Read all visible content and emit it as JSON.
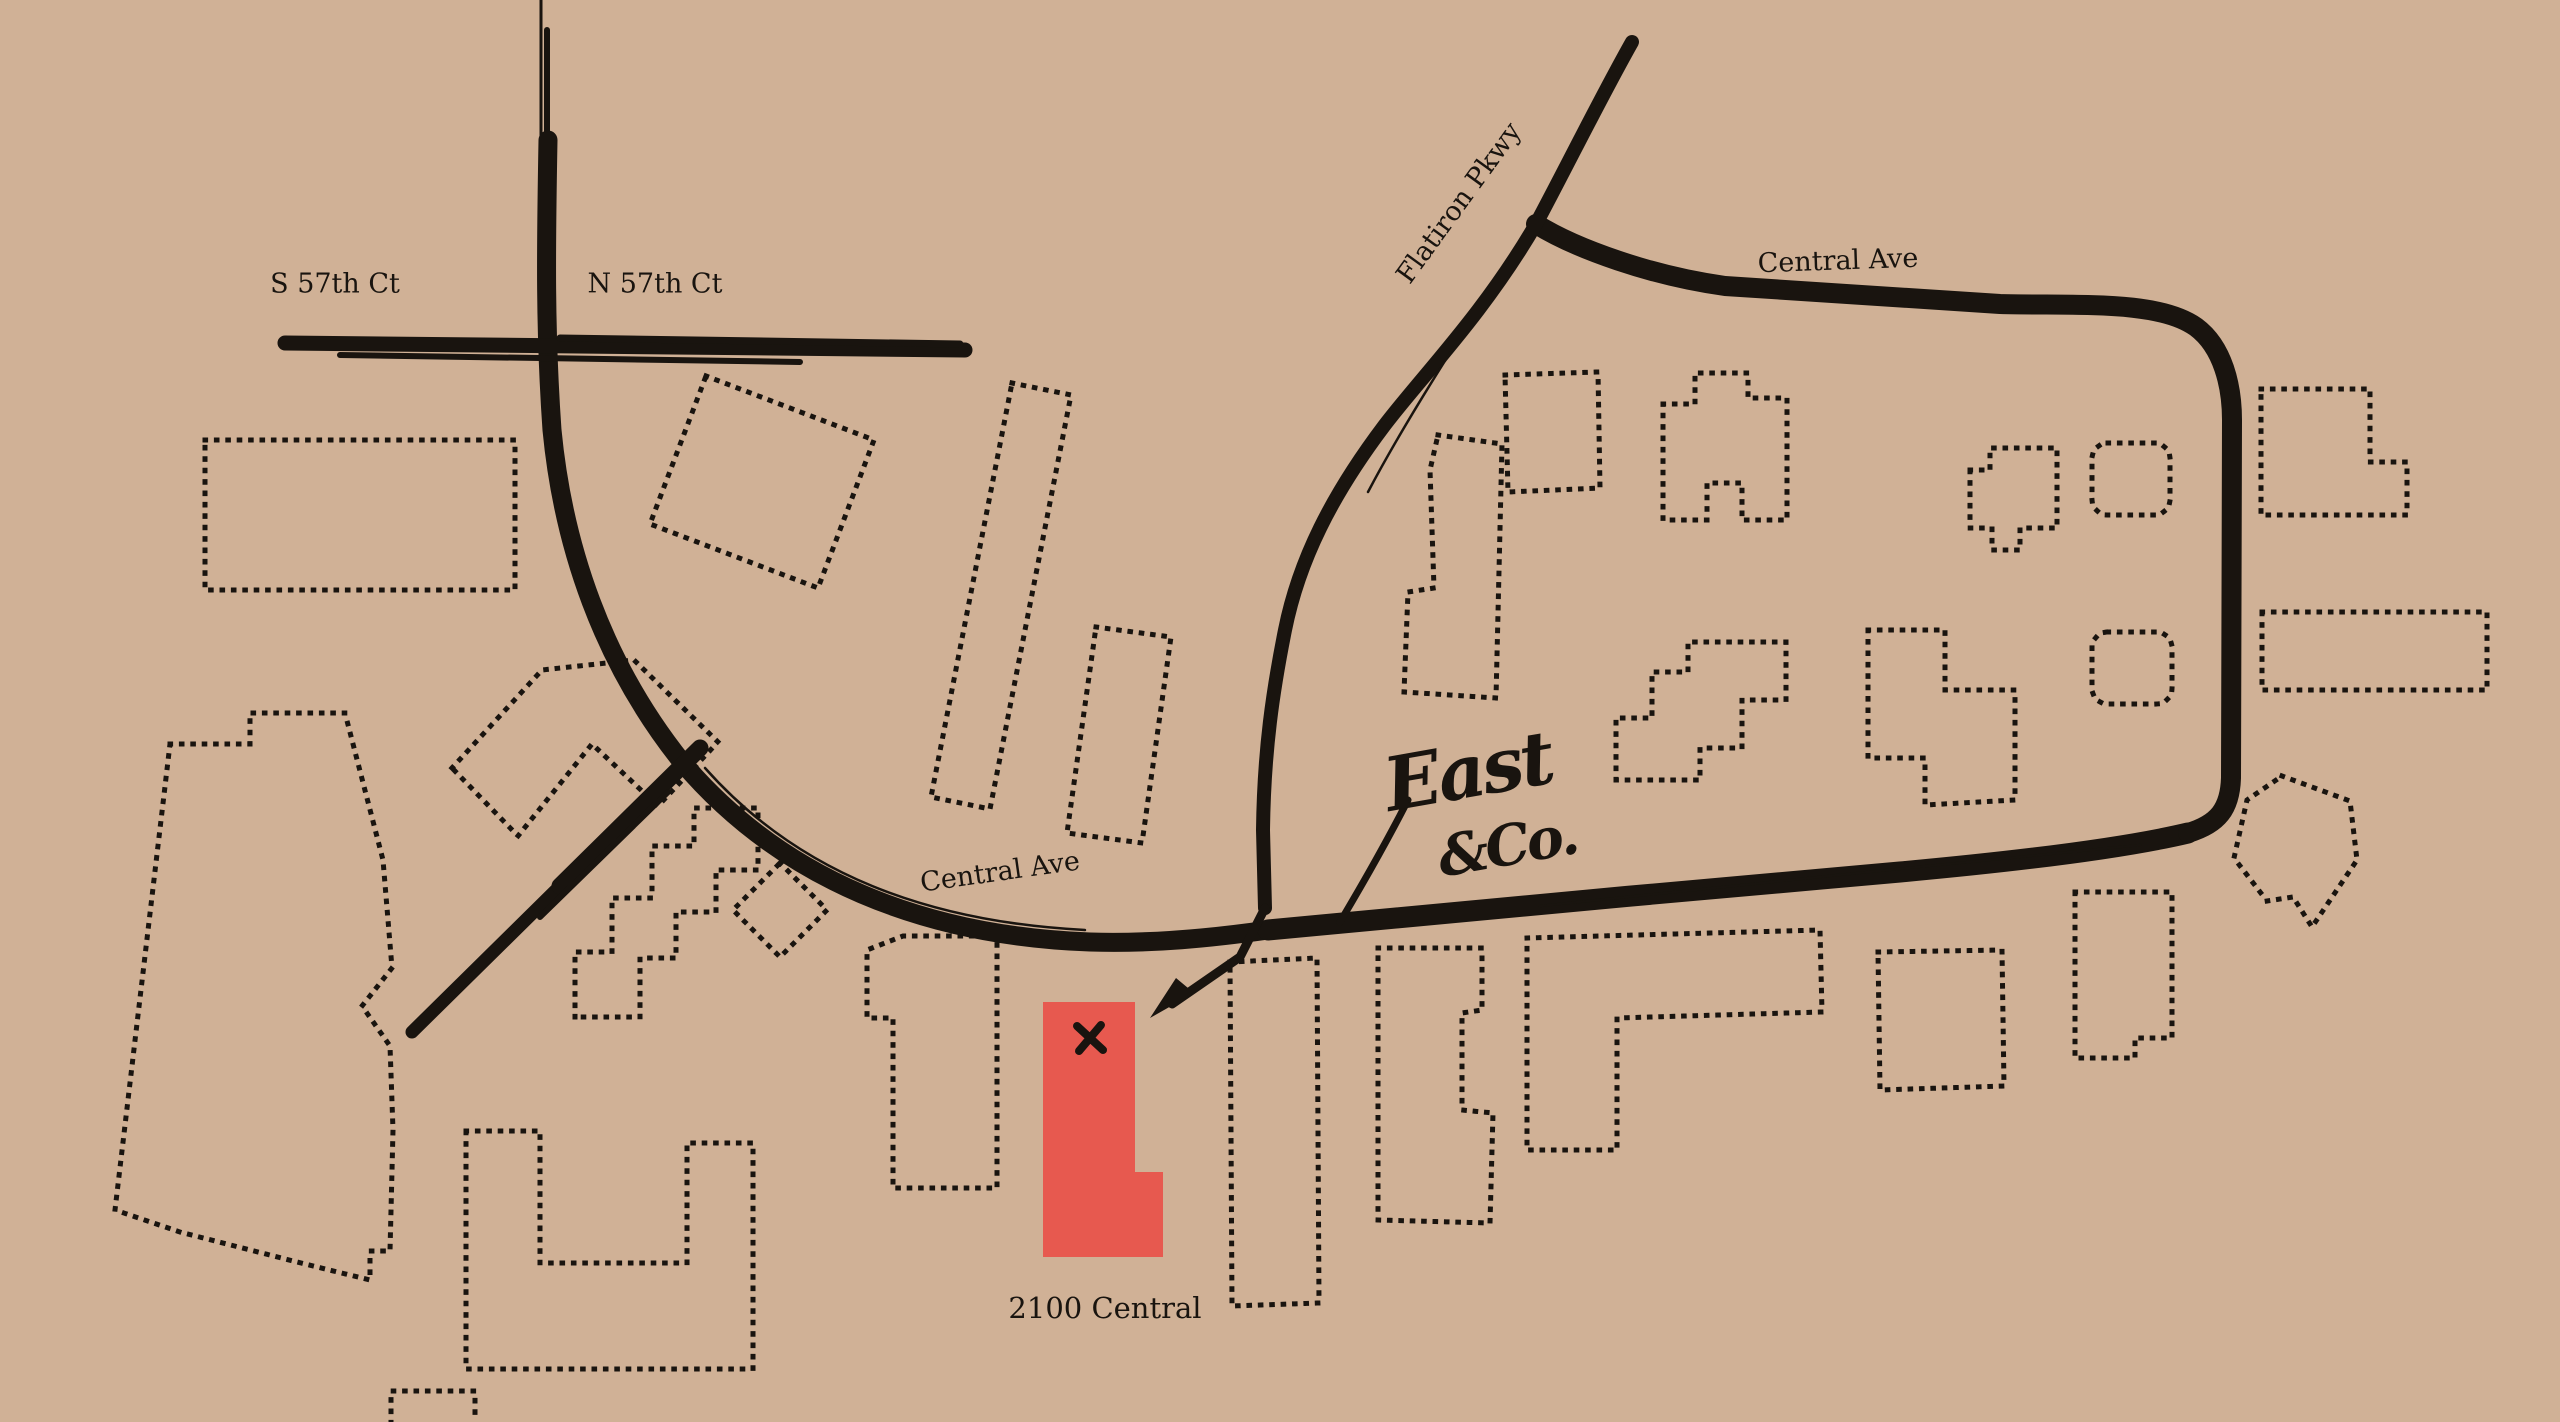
{
  "canvas": {
    "width": 2560,
    "height": 1422,
    "background_color": "#d0b196",
    "ink_color": "#19140f",
    "accent_color": "#e7594f"
  },
  "labels": {
    "s57th": {
      "text": "S 57th Ct",
      "x": 335,
      "y": 284,
      "rot": 0,
      "size": 27
    },
    "n57th": {
      "text": "N 57th Ct",
      "x": 655,
      "y": 284,
      "rot": 0,
      "size": 27
    },
    "flatiron": {
      "text": "Flatiron Pkwy",
      "x": 1459,
      "y": 203,
      "rot": -54,
      "size": 27
    },
    "central_top": {
      "text": "Central Ave",
      "x": 1838,
      "y": 261,
      "rot": -2,
      "size": 27
    },
    "central_bottom": {
      "text": "Central Ave",
      "x": 1000,
      "y": 872,
      "rot": -8,
      "size": 27
    },
    "address": {
      "text": "2100 Central",
      "x": 1105,
      "y": 1308,
      "rot": 0,
      "size": 29
    }
  },
  "logo": {
    "line1": "East",
    "line2": "&Co.",
    "x1": 1468,
    "y1": 772,
    "size1": 74,
    "x2": 1507,
    "y2": 846,
    "size2": 56,
    "rot": -10
  },
  "roads": [
    {
      "name": "road-57th-hairline-top",
      "d": "M541,0 L541,148",
      "w": 3
    },
    {
      "name": "road-vertical-thin",
      "d": "M547,30 L547,170",
      "w": 6
    },
    {
      "name": "road-central-arc",
      "d": "M548,140 C546,250 545,330 552,430 C563,545 602,662 682,762 C782,880 925,936 1090,942 C1152,944 1212,938 1268,930",
      "w": 19
    },
    {
      "name": "road-central-bottom",
      "d": "M1268,930 C1450,913 1700,889 1900,872 C2020,861 2125,848 2188,833",
      "w": 21
    },
    {
      "name": "road-central-loop",
      "d": "M2188,833 C2218,824 2230,809 2231,778 L2232,420 C2232,386 2223,347 2196,327 C2158,300 2080,306 2000,304 L1725,286 C1652,276 1576,249 1536,224",
      "w": 20
    },
    {
      "name": "road-flatiron-pkwy",
      "d": "M1632,42 C1602,95 1567,166 1536,224 C1483,315 1422,376 1384,426 C1332,495 1299,560 1285,630 C1273,690 1264,750 1263,830 L1265,908",
      "w": 14
    },
    {
      "name": "road-flatiron-arrow-shaft",
      "d": "M1265,908 L1240,957 L1172,1004",
      "w": 9
    },
    {
      "name": "road-branch-southwest",
      "d": "M700,748 L412,1032",
      "w": 13
    },
    {
      "name": "road-branch-southwest-2",
      "d": "M700,748 L560,886",
      "w": 17
    },
    {
      "name": "road-branch-southwest-3",
      "d": "M668,792 L540,917",
      "w": 6
    },
    {
      "name": "road-57th-ct",
      "d": "M285,343 L965,350",
      "w": 15
    },
    {
      "name": "road-57th-ct-understroke",
      "d": "M340,355 L800,362",
      "w": 6
    },
    {
      "name": "road-57th-ct-overstroke",
      "d": "M560,338 L960,344",
      "w": 7
    },
    {
      "name": "brush-hairline-arc",
      "d": "M705,768 C800,875 930,922 1085,930",
      "w": 2.5
    },
    {
      "name": "brush-hairline-bottom",
      "d": "M1540,906 C1720,886 1950,864 2140,845",
      "w": 2.5
    },
    {
      "name": "brush-hairline-flatiron",
      "d": "M1455,345 C1420,400 1390,450 1368,492",
      "w": 2.5
    },
    {
      "name": "logo-swash",
      "d": "M1408,800 C1385,845 1362,885 1340,922",
      "w": 7
    }
  ],
  "arrowhead": {
    "name": "arrow-head",
    "d": "M1150,1018 L1194,993 L1176,978 Z"
  },
  "buildings": [
    {
      "name": "building-nw-rectangle",
      "d": "M205,440 L515,440 L515,590 L205,590 Z"
    },
    {
      "name": "building-n-rotated-square",
      "d": "M706,376 L874,440 L818,588 L650,524 Z"
    },
    {
      "name": "building-w-large-lot",
      "d": "M170,744 L250,744 L250,713 L345,713 L383,860 L392,968 L362,1006 L390,1046 L393,1130 L390,1251 L370,1251 L370,1280 L297,1262 L180,1232 L115,1210 Z"
    },
    {
      "name": "building-w-chevron",
      "d": "M452,768 L542,670 L634,660 L718,742 L658,806 L592,744 L518,836 Z"
    },
    {
      "name": "building-center-staircase",
      "d": "M575,1017 L575,952 L612,952 L612,898 L652,898 L652,846 L694,846 L694,808 L758,808 L758,870 L716,870 L716,912 L676,912 L676,958 L640,958 L640,1017 Z"
    },
    {
      "name": "building-center-diamond",
      "d": "M780,863 L827,910 L780,957 L733,910 Z"
    },
    {
      "name": "building-center-tall-slab",
      "d": "M1012,383 L1071,395 L990,809 L931,797 Z"
    },
    {
      "name": "building-center-mid-slab",
      "d": "M1096,627 L1171,637 L1142,843 L1067,833 Z"
    },
    {
      "name": "building-center-south-1",
      "d": "M903,936 L997,936 L997,1188 L893,1188 L893,1018 L867,1018 L867,950 Z"
    },
    {
      "name": "building-sw-u-shape",
      "d": "M466,1131 L540,1131 L540,1263 L687,1263 L687,1143 L753,1143 L753,1369 L466,1369 Z"
    },
    {
      "name": "building-s-partial-rect",
      "d": "M391,1423 L391,1391 L475,1391 L475,1423"
    },
    {
      "name": "building-e-boot",
      "d": "M1438,435 L1502,444 L1496,698 L1404,692 L1408,592 L1434,588 L1430,470 Z"
    },
    {
      "name": "building-fork-rect",
      "d": "M1505,375 L1598,372 L1600,488 L1508,492 Z"
    },
    {
      "name": "building-ne-castle",
      "d": "M1663,404 L1695,404 L1695,373 L1748,373 L1748,398 L1787,398 L1787,520 L1742,520 L1742,483 L1707,483 L1707,520 L1663,520 Z"
    },
    {
      "name": "building-ne-steps",
      "d": "M1616,780 L1616,718 L1652,718 L1652,672 L1688,672 L1688,642 L1786,642 L1786,700 L1742,700 L1742,748 L1700,748 L1700,780 Z"
    },
    {
      "name": "building-ne-notched",
      "d": "M1868,630 L1945,630 L1945,690 L2015,690 L2015,800 L1925,805 L1925,758 L1868,758 Z"
    },
    {
      "name": "building-ne-q-shape",
      "d": "M1970,470 L1990,470 L1990,448 L2057,448 L2057,528 L2020,528 L2020,550 L1992,550 L1992,528 L1970,528 Z"
    },
    {
      "name": "building-loop-round-a",
      "rect": [
        2092,
        443,
        78,
        72
      ],
      "rx": 16
    },
    {
      "name": "building-loop-round-b",
      "rect": [
        2092,
        632,
        80,
        72
      ],
      "rx": 16
    },
    {
      "name": "building-far-ne-l-shape",
      "d": "M2261,389 L2370,389 L2370,462 L2407,462 L2407,515 L2261,515 Z"
    },
    {
      "name": "building-far-e-wide-rect",
      "d": "M2262,612 L2487,612 L2487,690 L2262,690 Z"
    },
    {
      "name": "building-se-pentagon",
      "d": "M2282,776 L2350,801 L2357,860 L2312,927 L2293,897 L2267,901 L2234,858 L2247,800 Z"
    },
    {
      "name": "building-se-notched-rect",
      "d": "M2075,892 L2172,892 L2172,1038 L2135,1038 L2135,1058 L2075,1058 Z"
    },
    {
      "name": "building-se-small-rect",
      "d": "M1878,952 L2002,950 L2004,1086 L1880,1090 Z"
    },
    {
      "name": "building-se-gamma",
      "d": "M1527,938 L1820,930 L1822,1012 L1617,1018 L1617,1150 L1527,1150 Z"
    },
    {
      "name": "building-s-notched-tall",
      "d": "M1378,948 L1482,948 L1482,1010 L1462,1013 L1462,1110 L1493,1113 L1490,1223 L1378,1220 Z"
    },
    {
      "name": "building-s-tall-rect",
      "d": "M1230,962 L1317,958 L1319,1303 L1232,1306 Z"
    }
  ],
  "highlight": {
    "name": "building-2100-central",
    "d": "M1043,1002 L1135,1002 L1135,1172 L1163,1172 L1163,1257 L1043,1257 Z"
  },
  "marker": {
    "name": "x-marker",
    "strokes": [
      "M1077,1026 L1103,1050",
      "M1101,1025 L1079,1051"
    ],
    "w": 8
  }
}
